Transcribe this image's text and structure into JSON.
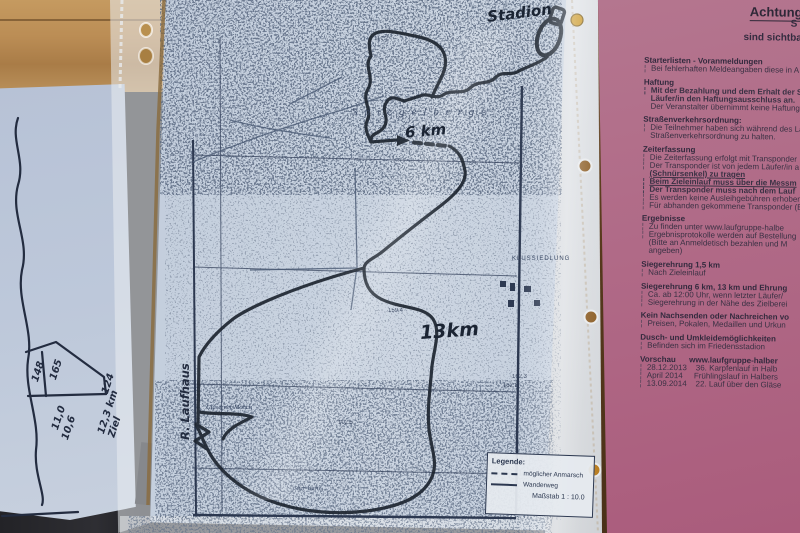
{
  "colors": {
    "pink_sheet": "#b06a87",
    "map_paper": "#c6d0de",
    "wood": "#bb8d55",
    "route_ink": "#1d2530",
    "stamp_red": "#6d2437"
  },
  "course_map": {
    "handwritten": {
      "stadium": "Stadion",
      "km6": "6 km",
      "km13": "13km",
      "left_note": "R. Laufhaus"
    },
    "print_labels": {
      "ridge": "Spiegelberge",
      "settlement": "KLUSSIEDLUNG",
      "moench": "Gläserner Mönch",
      "warte": "Stier-Warte"
    },
    "spot_heights": [
      {
        "t": "117.2",
        "x": 374,
        "y": 36
      },
      {
        "t": "159.4",
        "x": 388,
        "y": 308
      },
      {
        "t": "152.8",
        "x": 503,
        "y": 383
      },
      {
        "t": "162.3",
        "x": 512,
        "y": 374
      },
      {
        "t": "102.5",
        "x": 338,
        "y": 420
      }
    ],
    "legend": {
      "title": "Legende:",
      "dashed_label": "möglicher Anmarsch",
      "solid_label": "Wanderweg",
      "scale": "Maßstab 1 : 10.0"
    }
  },
  "profile_sheet": {
    "h148": "148",
    "h165": "165",
    "h124": "124",
    "d110": "11,0",
    "d106": "10,6",
    "ziel": "12,3 km\nZiel"
  },
  "info_sheet": {
    "title": "Achtung",
    "fragment": "S",
    "visible_line": "sind sichtbar",
    "lines": [
      {
        "t": "Starterlisten - Voranmeldungen",
        "h": 1
      },
      {
        "t": "Bei fehlerhaften Meldeangaben diese in A",
        "bl": 1
      },
      {
        "t": "Haftung",
        "h": 1,
        "g": 1
      },
      {
        "t": "Mit der Bezahlung und dem Erhalt der St",
        "b": 1,
        "bl": 1
      },
      {
        "t": "Läufer/in den Haftungsausschluss an.",
        "b": 1,
        "i": 2
      },
      {
        "t": "Der Veranstalter übernimmt keine Haftung,",
        "i": 2
      },
      {
        "t": "Straßenverkehrsordnung:",
        "h": 1,
        "g": 1
      },
      {
        "t": "Die Teilnehmer haben sich während des Lau",
        "bl": 1
      },
      {
        "t": "Straßenverkehrsordnung zu halten.",
        "i": 2
      },
      {
        "t": "Zeiterfassung",
        "h": 1,
        "g": 1
      },
      {
        "t": "Die Zeiterfassung erfolgt mit Transponder",
        "bl": 1
      },
      {
        "t": "Der Transponder ist von jedem Läufer/in a",
        "bl": 1
      },
      {
        "t": "(Schnürsenkel) zu tragen",
        "b": 1,
        "u": 1,
        "i": 2
      },
      {
        "t": "Beim Zieleinlauf muss über die Messm",
        "b": 1,
        "u": 1,
        "bl": 1
      },
      {
        "t": "Der Transponder muss nach dem Lauf",
        "b": 1,
        "bl": 1
      },
      {
        "t": "Es werden keine Ausleihgebühren erhoben",
        "bl": 1
      },
      {
        "t": "Für abhanden gekommene Transponder (B",
        "bl": 1
      },
      {
        "t": "Ergebnisse",
        "h": 1,
        "g": 1
      },
      {
        "t": "Zu finden unter www.laufgruppe-halbe",
        "bl": 1
      },
      {
        "t": "Ergebnisprotokolle werden auf Bestellung",
        "bl": 1
      },
      {
        "t": "(Bitte an Anmeldetisch bezahlen und M",
        "i": 2
      },
      {
        "t": "angeben)",
        "i": 2
      },
      {
        "t": "Siegerehrung 1,5 km",
        "h": 1,
        "g": 1
      },
      {
        "t": "Nach Zieleinlauf",
        "bl": 1
      },
      {
        "t": "Siegerehrung 6 km, 13 km und Ehrung",
        "h": 1,
        "g": 1
      },
      {
        "t": "Ca. ab 12:00 Uhr, wenn letzter Läufer/",
        "bl": 1
      },
      {
        "t": "Siegerehrung in der Nähe des Zielberei",
        "bl": 1
      },
      {
        "t": "Kein Nachsenden oder Nachreichen vo",
        "h": 1,
        "g": 1
      },
      {
        "t": "Preisen, Pokalen, Medaillen und Urkun",
        "bl": 1
      },
      {
        "t": "Dusch- und Umkleidemöglichkeiten",
        "h": 1,
        "g": 1
      },
      {
        "t": "Befinden sich im Friedensstadion",
        "bl": 1
      },
      {
        "t": "Vorschau      www.laufgruppe-halber",
        "h": 1,
        "g": 1
      },
      {
        "t": "28.12.2013    36. Karpfenlauf in Halb",
        "bl": 1
      },
      {
        "t": "April 2014     Frühlingslauf in Halbers",
        "bl": 1
      },
      {
        "t": "13.09.2014    22. Lauf über den Gläse",
        "bl": 1
      }
    ],
    "stamp_bottom": {
      "top": "Laufgruppe",
      "bottom": "Halberstadt"
    }
  }
}
